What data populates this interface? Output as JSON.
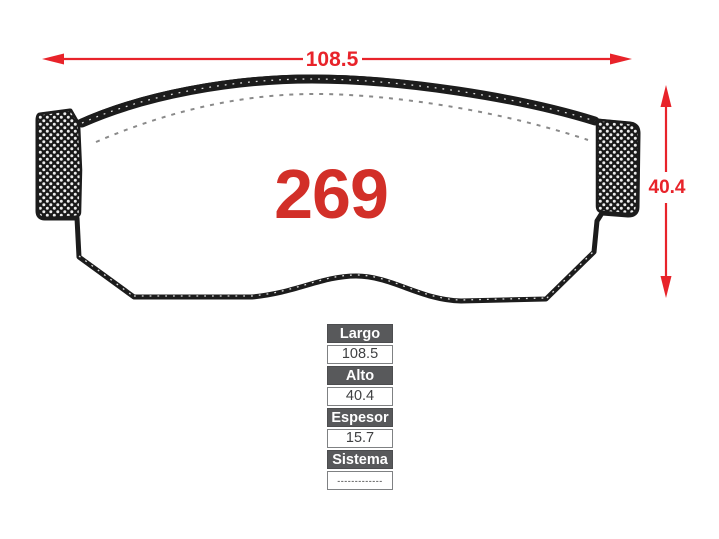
{
  "drawing": {
    "part_number": "269",
    "width_label": "108.5",
    "height_label": "40.4"
  },
  "spec_table": {
    "rows": [
      {
        "label": "Largo",
        "value": "108.5"
      },
      {
        "label": "Alto",
        "value": "40.4"
      },
      {
        "label": "Espesor",
        "value": "15.7"
      },
      {
        "label": "Sistema",
        "value": "-------------"
      }
    ]
  },
  "colors": {
    "dimension_red": "#e8232a",
    "part_number_red": "#d22f28",
    "table_header_bg": "#58595b",
    "table_border": "#7f8183",
    "table_value_text": "#3f4042",
    "outline_dark": "#1c1c1c"
  }
}
